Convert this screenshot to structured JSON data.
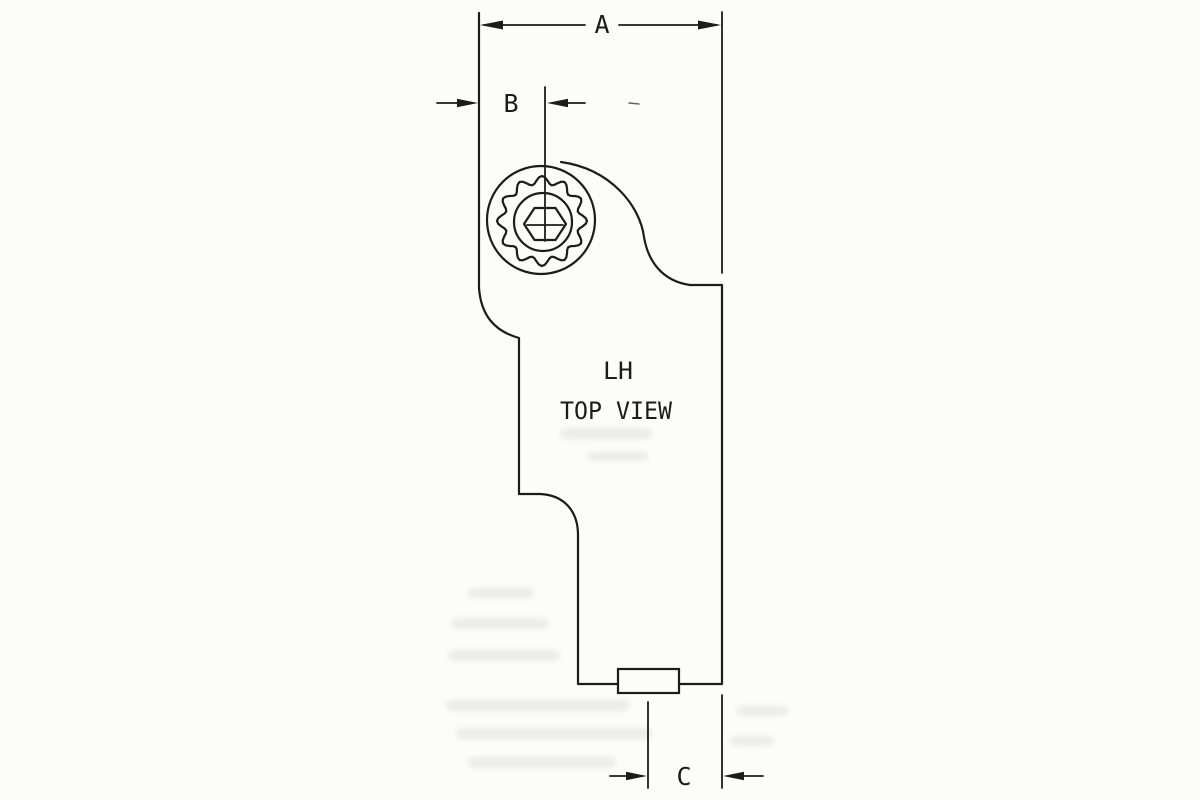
{
  "colors": {
    "ink": "#1c1c1c",
    "paper": "#fcfcfa",
    "ghost": "#9a9a9a"
  },
  "drawing": {
    "view_label_line1": "LH",
    "view_label_line2": "TOP VIEW",
    "dim_a_label": "A",
    "dim_b_label": "B",
    "dim_c_label": "C"
  }
}
